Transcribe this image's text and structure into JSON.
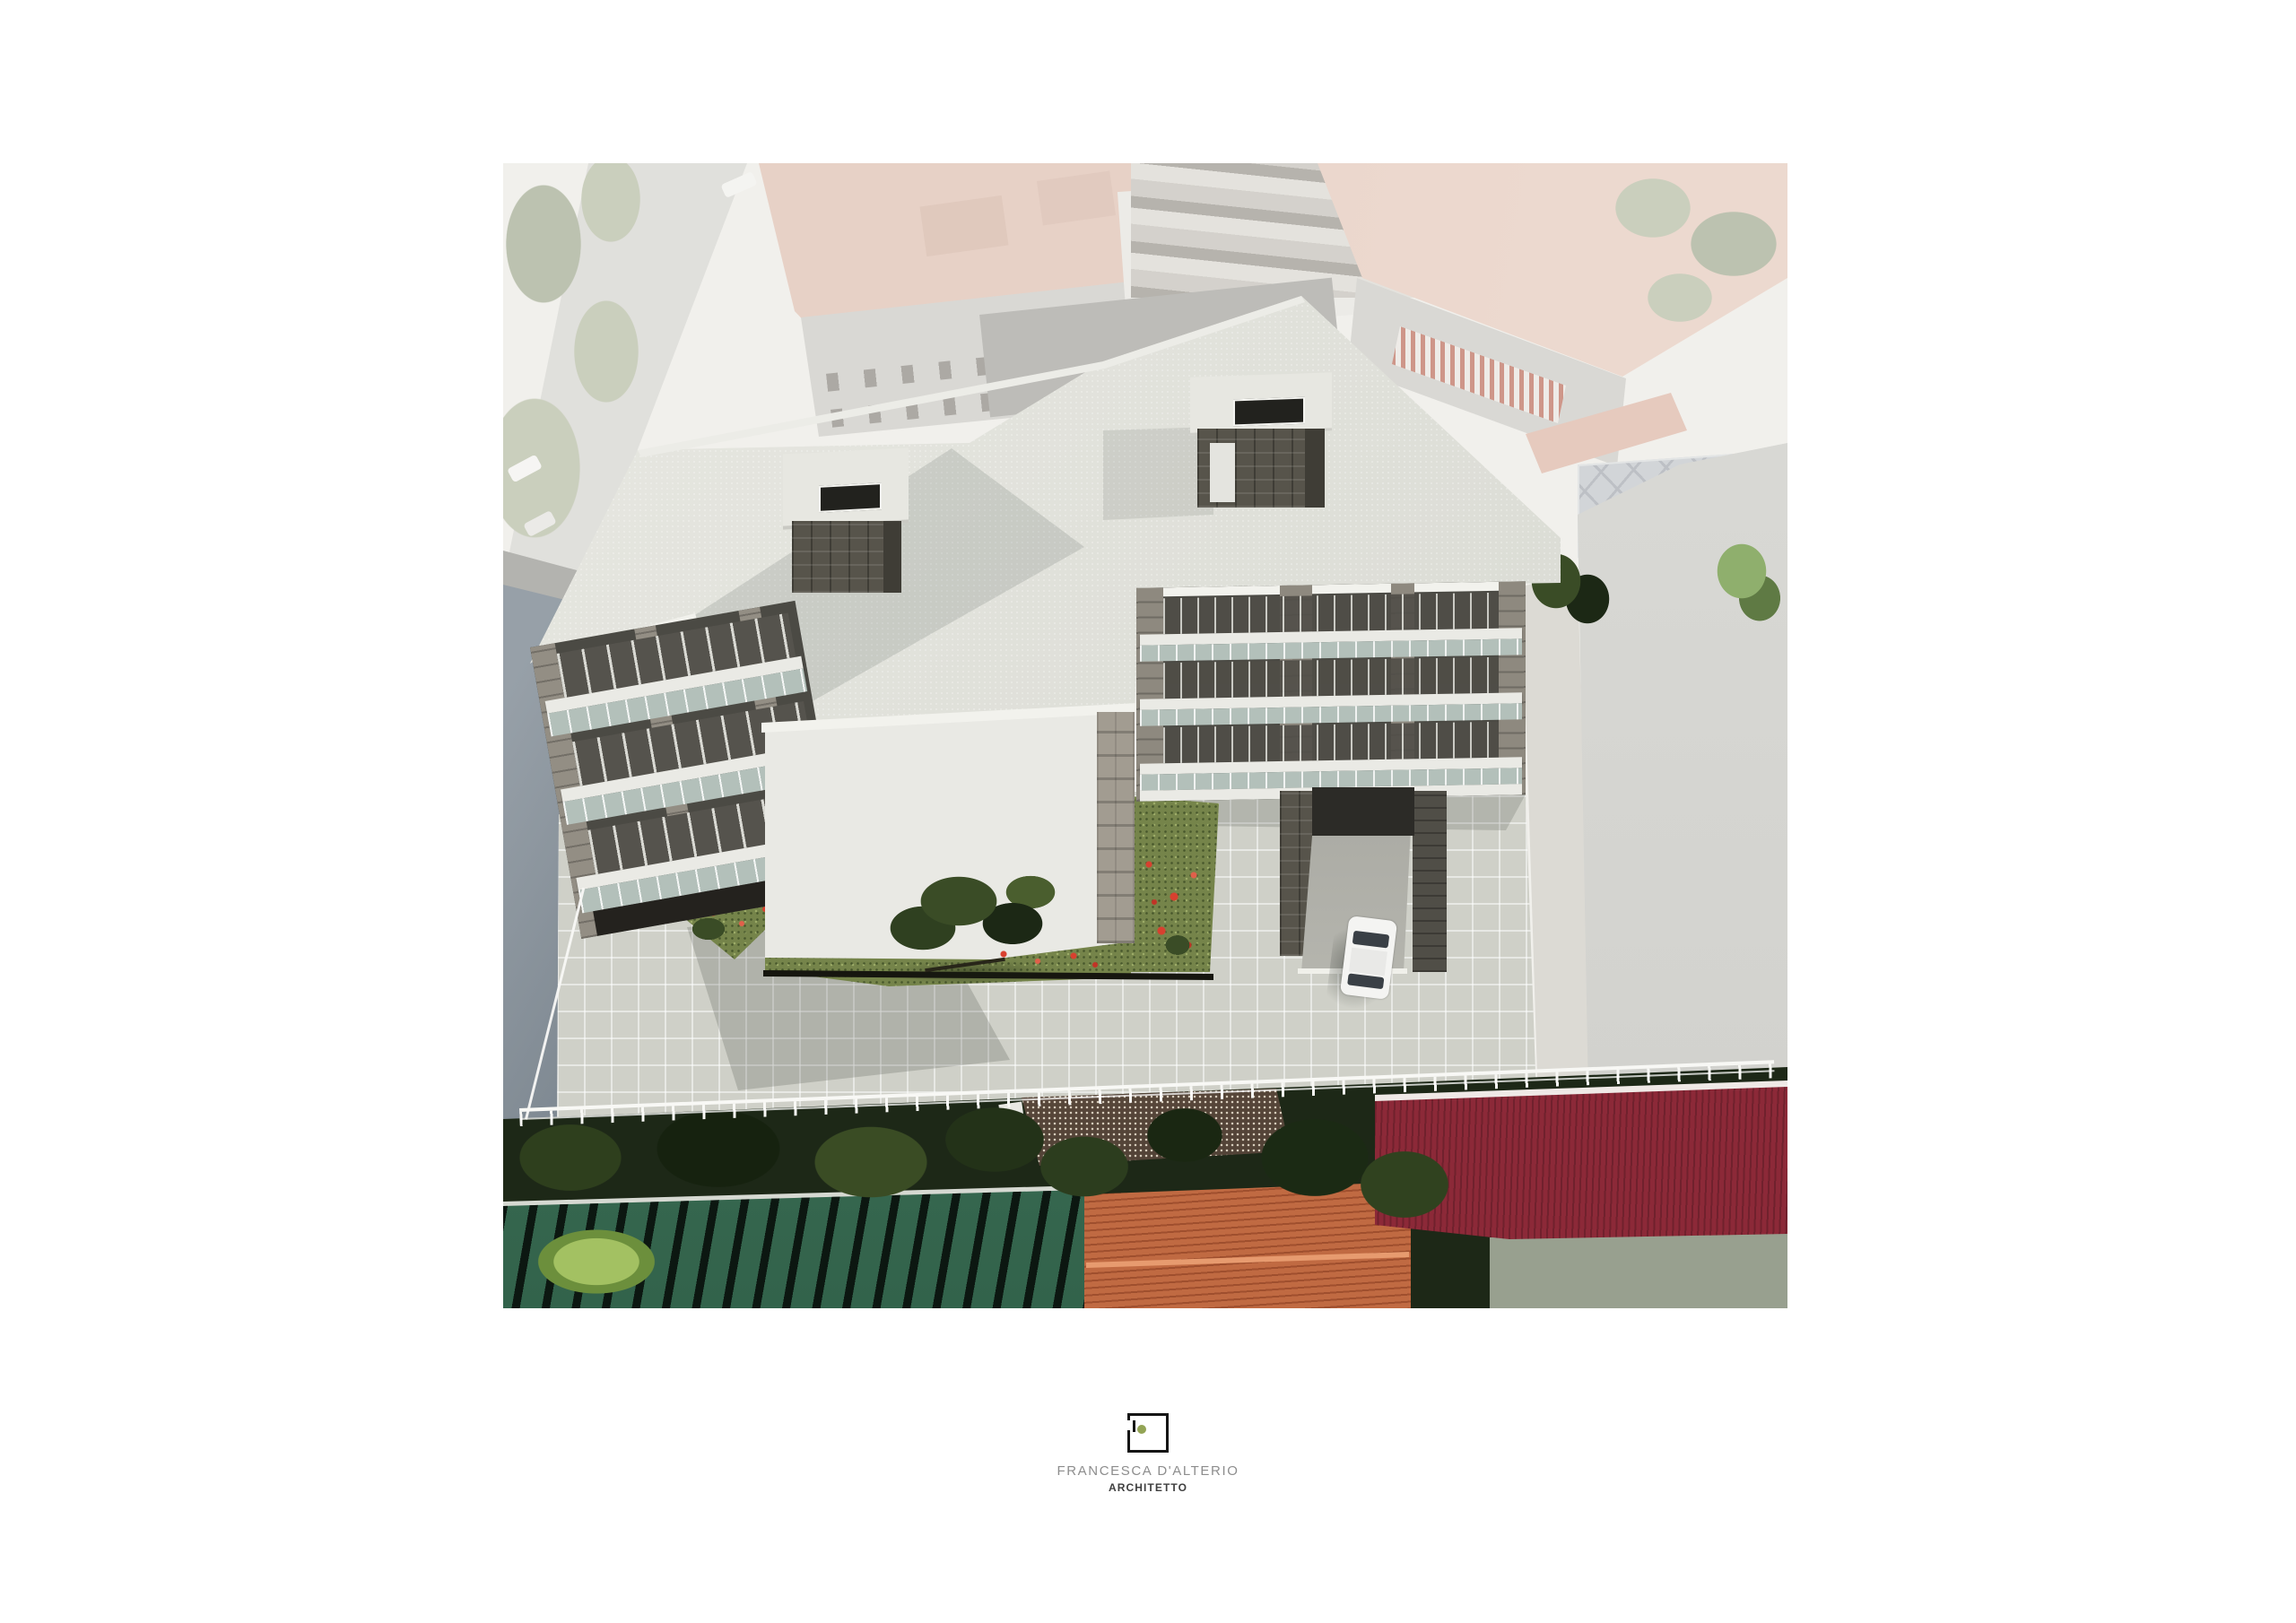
{
  "logo": {
    "studio_name": "FRANCESCA D'ALTERIO",
    "profession": "ARCHITETTO"
  },
  "scene": {
    "subject": "Aerial photomontage rendering of a new three-storey apartment building with flat white roof, two stone stair towers, balconied facades, paved courtyard, lawns with red poppies, underground garage ramp, white parked car and white perimeter fence, inserted into a faded aerial photograph of the surrounding neighbourhood",
    "elements": [
      "main-building-roof",
      "left-wing-facade",
      "right-wing-facade",
      "gable-end-wall",
      "stair-tower-left",
      "stair-tower-right",
      "courtyard-paving",
      "courtyard-lawn",
      "garage-ramp",
      "white-car",
      "perimeter-fence",
      "neighbor-terracotta-roofs",
      "green-corrugated-roof",
      "orange-tile-roof",
      "maroon-roof",
      "tree-canopy",
      "aerial-roads"
    ]
  },
  "palette": {
    "page_bg": "#ffffff",
    "photo_base": "#f1f0ec",
    "washed_road": "#d2d2cf",
    "washed_green": "#a8b193",
    "washed_green_dark": "#8d9a7a",
    "salmon_roof": "#dfb5a4",
    "salmon_dark": "#cda28f",
    "washed_facade": "#c5c4c0",
    "washed_window": "#514b44",
    "awning_red": "#b0452f",
    "washed_asphalt": "#8f8e8a",
    "canopy_blue": "#b6bdc6",
    "canopy_rib": "#8f96a2",
    "pink_path": "#dca896",
    "adj_wall_light": "#97a0a8",
    "adj_wall_dark": "#39434d",
    "adj_wall_edge": "#2c353e",
    "roof_sliver": "#b3b3af",
    "boundary_wall": "#dcdad4",
    "side_road": "#d0d0cc",
    "bush_green": "#8faf6d",
    "render_roof": "#dcddd6",
    "render_roof_light": "#e9e9e3",
    "fascia": "#f2f2ed",
    "cap": "#e7e7e1",
    "cap_hole": "#22221e",
    "stone": "#57544b",
    "stone_face": "#3f3d36",
    "stone_light": "#a29c91",
    "recess": "#4b4a44",
    "pier": "#938e84",
    "slab": "#eaeae5",
    "glass": "#b3c0ba",
    "undercroft": "#24221e",
    "gable_light": "#e9e9e4",
    "gable_shade": "#d8d8d2",
    "tile": "#cfd0c8",
    "lawn": "#75844a",
    "poppy": "#d8402f",
    "tree_dark": "#1c2815",
    "tree_mid": "#3a4c26",
    "tree_gray": "#4c5844",
    "ramp_floor": "#c9c9c2",
    "garage": "#2c2b27",
    "car": "#f4f4f2",
    "car_glass": "#3a4046",
    "fence": "#f8f8f5",
    "corr_green": "#3b7458",
    "corr_stripe": "#0c1711",
    "shed_light": "#7d6553",
    "orange": "#c06a42",
    "orange_ridge": "#e79b6f",
    "maroon": "#8c2938",
    "sage": "#98a08f",
    "logo_frame": "#151515",
    "logo_dot": "#93a455",
    "logo_name": "#8d8d8d",
    "logo_title": "#3f3f3f"
  }
}
